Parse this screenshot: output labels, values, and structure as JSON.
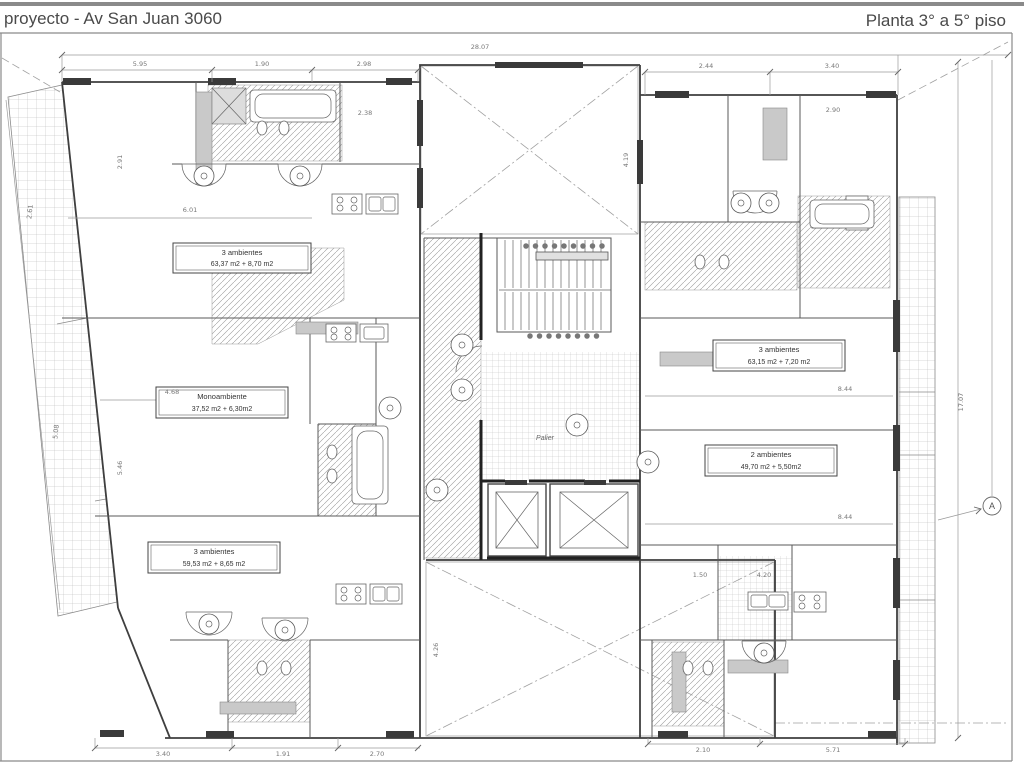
{
  "page": {
    "title_left": "proyecto - Av San Juan 3060",
    "title_right": "Planta 3° a  5° piso"
  },
  "plan": {
    "core_label": "Palier",
    "axis_marker": "A",
    "units": [
      {
        "id": "nw",
        "type": "3 ambientes",
        "area": "63,37 m2 + 8,70 m2"
      },
      {
        "id": "w",
        "type": "Monoambiente",
        "area": "37,52 m2 + 6,30m2"
      },
      {
        "id": "sw",
        "type": "3 ambientes",
        "area": "59,53 m2 + 8,65 m2"
      },
      {
        "id": "ne",
        "type": "3 ambientes",
        "area": "63,15 m2 + 7,20 m2"
      },
      {
        "id": "e",
        "type": "2 ambientes",
        "area": "49,70 m2 + 5,50m2"
      }
    ],
    "dimensions": [
      {
        "x": 480,
        "y": 49,
        "v": "28.07"
      },
      {
        "x": 140,
        "y": 66,
        "v": "5.95"
      },
      {
        "x": 262,
        "y": 66,
        "v": "1.90"
      },
      {
        "x": 364,
        "y": 66,
        "v": "2.98"
      },
      {
        "x": 706,
        "y": 68,
        "v": "2.44"
      },
      {
        "x": 832,
        "y": 68,
        "v": "3.40"
      },
      {
        "x": 163,
        "y": 756,
        "v": "3.40"
      },
      {
        "x": 283,
        "y": 756,
        "v": "1.91"
      },
      {
        "x": 377,
        "y": 756,
        "v": "2.70"
      },
      {
        "x": 703,
        "y": 752,
        "v": "2.10"
      },
      {
        "x": 833,
        "y": 752,
        "v": "5.71"
      },
      {
        "x": 963,
        "y": 402,
        "v": "17.07",
        "r": -90
      },
      {
        "x": 32,
        "y": 212,
        "v": "2.61",
        "r": -84
      },
      {
        "x": 58,
        "y": 432,
        "v": "5.08",
        "r": -84
      },
      {
        "x": 190,
        "y": 212,
        "v": "6.01"
      },
      {
        "x": 172,
        "y": 394,
        "v": "4.68"
      },
      {
        "x": 845,
        "y": 391,
        "v": "8.44"
      },
      {
        "x": 845,
        "y": 519,
        "v": "8.44"
      },
      {
        "x": 628,
        "y": 160,
        "v": "4.19",
        "r": -90
      },
      {
        "x": 438,
        "y": 650,
        "v": "4.26",
        "r": -90
      },
      {
        "x": 365,
        "y": 115,
        "v": "2.38"
      },
      {
        "x": 833,
        "y": 112,
        "v": "2.90"
      },
      {
        "x": 700,
        "y": 577,
        "v": "1.50"
      },
      {
        "x": 764,
        "y": 577,
        "v": "4.20"
      },
      {
        "x": 122,
        "y": 162,
        "v": "2.91",
        "r": -90
      },
      {
        "x": 122,
        "y": 468,
        "v": "5.46",
        "r": -90
      }
    ],
    "colors": {
      "line": "#4f4f4f",
      "window": "#3a3a3a",
      "hatch": "#999999",
      "title_text": "#4a4a4a"
    }
  }
}
